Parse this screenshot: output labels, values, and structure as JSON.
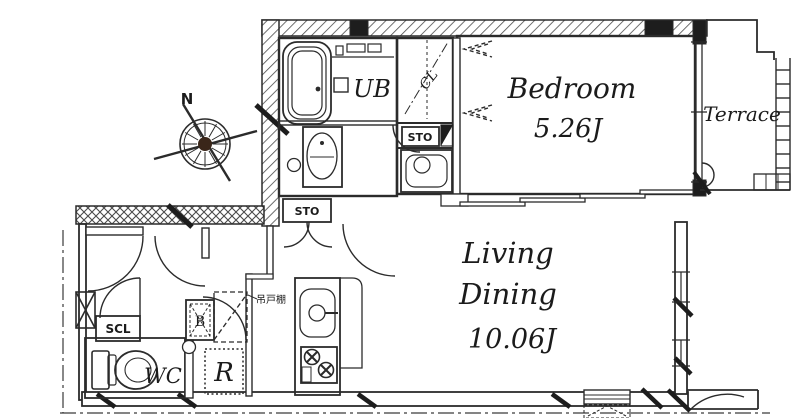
{
  "plan": {
    "compass": {
      "north_label": "N"
    },
    "bedroom": {
      "name": "Bedroom",
      "area": "5.26J"
    },
    "living_dining": {
      "name_line1": "Living",
      "name_line2": "Dining",
      "area": "10.06J"
    },
    "terrace": {
      "name": "Terrace"
    },
    "unit_bath": {
      "name": "UB"
    },
    "closet": {
      "name": "CL"
    },
    "storage_upper": {
      "name": "STO"
    },
    "storage_hall": {
      "name": "STO"
    },
    "shoe_closet": {
      "name": "SCL"
    },
    "toilet_room": {
      "name": "WC"
    },
    "utility_b": {
      "name": "B"
    },
    "refrigerator": {
      "name": "R"
    },
    "hanging_cupboard": {
      "name": "吊戸棚"
    }
  },
  "colors": {
    "line": "#2b2b2b",
    "paper": "#ffffff",
    "compass_center": "#3a2619"
  }
}
